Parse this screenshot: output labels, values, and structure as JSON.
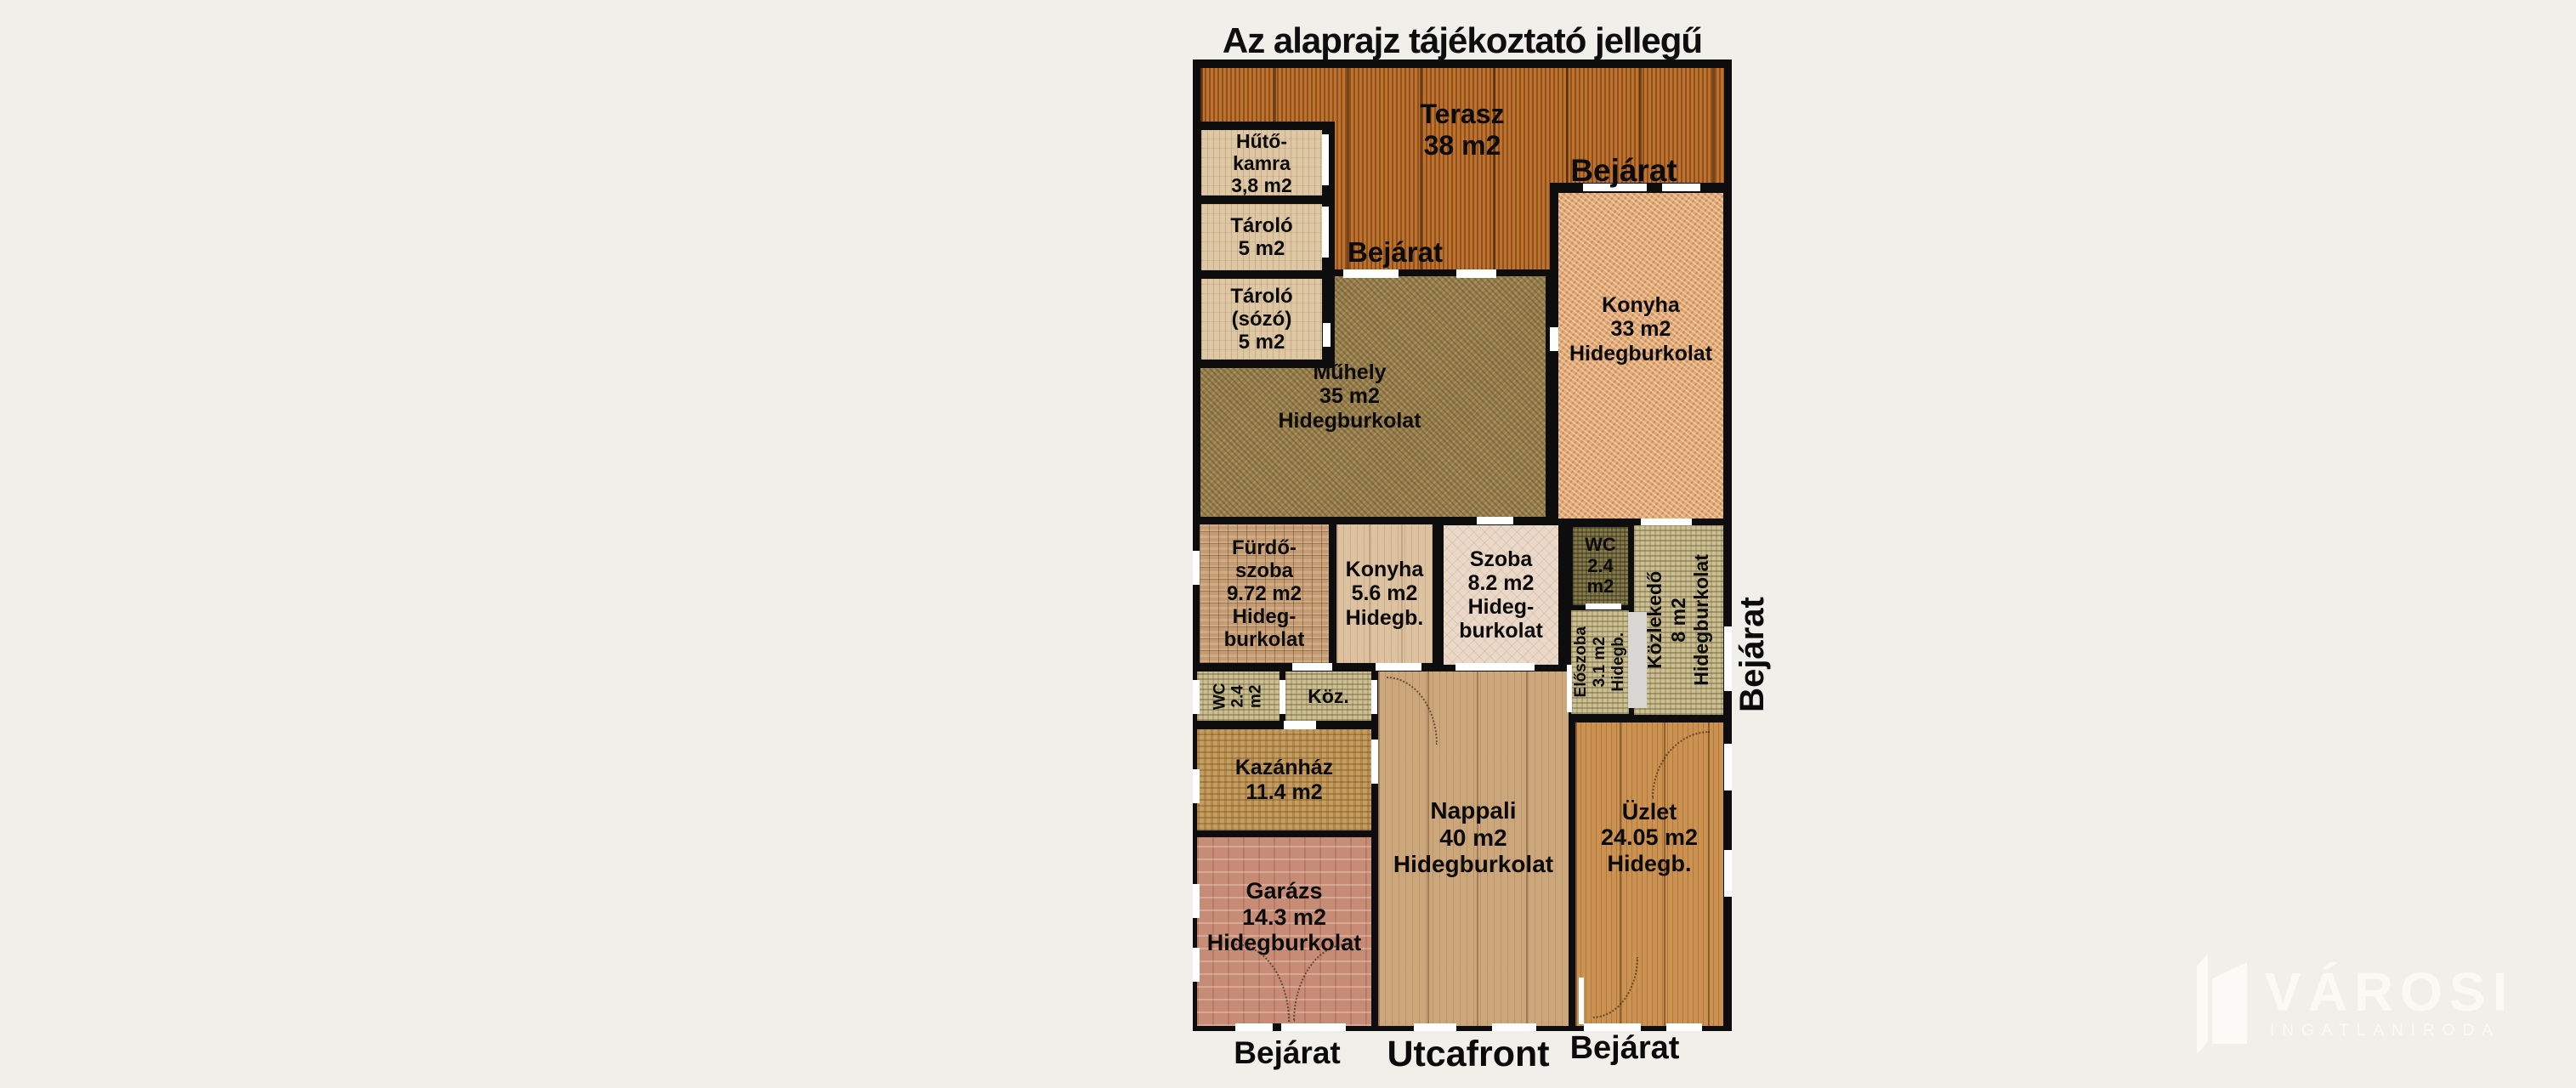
{
  "title": "Az alaprajz tájékoztató jellegű",
  "rooms": {
    "terasz": {
      "lines": [
        "Terasz",
        "38 m2"
      ]
    },
    "hutokamra": {
      "lines": [
        "Hűtő-",
        "kamra",
        "3,8 m2"
      ]
    },
    "tarolo": {
      "lines": [
        "Tároló",
        "5 m2"
      ]
    },
    "tarolo_sozo": {
      "lines": [
        "Tároló",
        "(sózó)",
        "5 m2"
      ]
    },
    "muhely": {
      "lines": [
        "Műhely",
        "35 m2",
        "Hidegburkolat"
      ]
    },
    "konyha_nagy": {
      "lines": [
        "Konyha",
        "33 m2",
        "Hidegburkolat"
      ]
    },
    "furdoszoba": {
      "lines": [
        "Fürdő-",
        "szoba",
        "9.72 m2",
        "Hideg-",
        "burkolat"
      ]
    },
    "konyha_kis": {
      "lines": [
        "Konyha",
        "5.6 m2",
        "Hidegb."
      ]
    },
    "szoba": {
      "lines": [
        "Szoba",
        "8.2 m2",
        "Hideg-",
        "burkolat"
      ]
    },
    "wc_felso": {
      "lines": [
        "WC",
        "2.4",
        "m2"
      ]
    },
    "eloszoba": {
      "lines": [
        "Előszoba",
        "3.1 m2",
        "Hidegb."
      ]
    },
    "kozlekedo": {
      "lines": [
        "Közlekedő",
        "8 m2",
        "Hidegburkolat"
      ]
    },
    "wc_also": {
      "lines": [
        "WC",
        "2.4",
        "m2"
      ]
    },
    "koz": {
      "lines": [
        "Köz."
      ]
    },
    "kazanhaz": {
      "lines": [
        "Kazánház",
        "11.4 m2"
      ]
    },
    "garazs": {
      "lines": [
        "Garázs",
        "14.3 m2",
        "Hidegburkolat"
      ]
    },
    "nappali": {
      "lines": [
        "Nappali",
        "40 m2",
        "Hidegburkolat"
      ]
    },
    "uzlet": {
      "lines": [
        "Üzlet",
        "24.05 m2",
        "Hidegb."
      ]
    }
  },
  "labels": {
    "bejarat": "Bejárat",
    "utcafront": "Utcafront"
  },
  "watermark": {
    "brand": "VÁROSI",
    "tagline": "INGATLANIRODA"
  },
  "colors": {
    "background": "#f0efe9",
    "walls": "#0d0d0d",
    "terrace": "#c0712b",
    "shop_wood": "#cc9251",
    "door_opening": "#ffffff"
  }
}
